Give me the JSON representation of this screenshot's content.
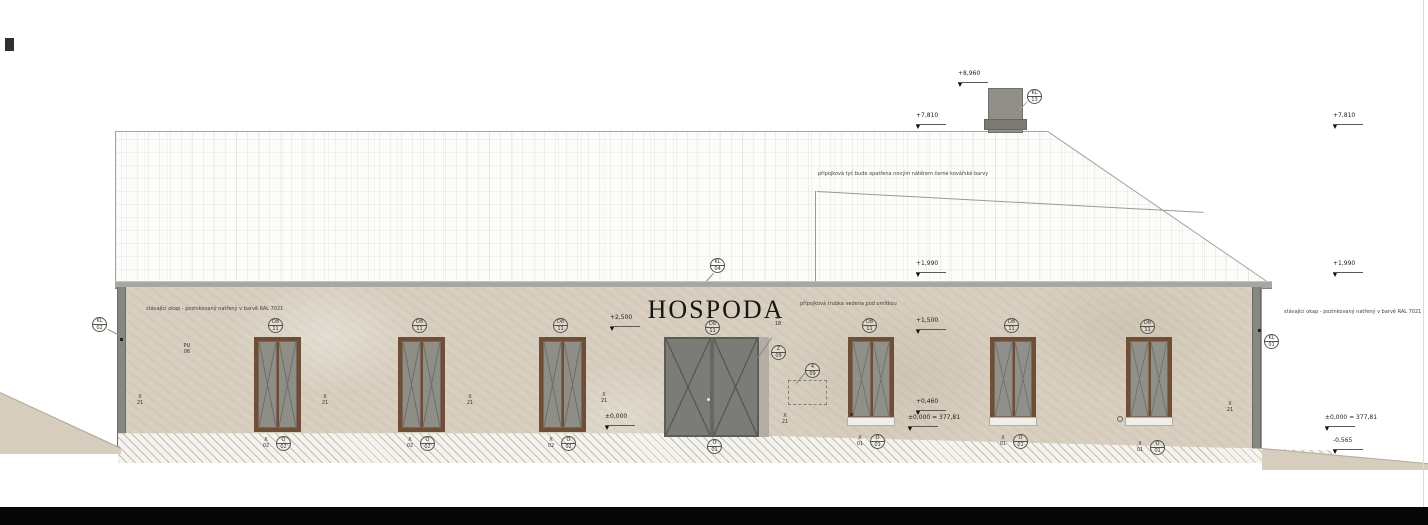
{
  "sign": {
    "text": "HOSPODA"
  },
  "colors": {
    "wall": "#d8cfc0",
    "roof": "#fcfcfb",
    "frame_brown": "#6e4e36",
    "door_gray": "#7b7b77",
    "gutter_gray": "#a7a7a1",
    "ground_black": "#070707"
  },
  "notes": [
    {
      "text": "stávající okap - pozinkovaný natřený v barvě RAL 7021",
      "x": 146,
      "y": 306
    },
    {
      "text": "stávající okap - pozinkovaný natřený v barvě RAL 7021",
      "x": 1284,
      "y": 309
    },
    {
      "text": "přípojková tyč bude opatřena novým nátěrem černé kovářské barvy",
      "x": 818,
      "y": 171
    },
    {
      "text": "přípojková trubka vedena pod omítkou",
      "x": 800,
      "y": 301
    }
  ],
  "circle_markers": [
    {
      "top": "KL",
      "bot": "02",
      "x": 92,
      "y": 317
    },
    {
      "top": "KL",
      "bot": "04",
      "x": 710,
      "y": 258
    },
    {
      "top": "KL",
      "bot": "13",
      "x": 1027,
      "y": 89
    },
    {
      "top": "KL",
      "bot": "01",
      "x": 1264,
      "y": 334
    },
    {
      "top": "D8",
      "bot": "11",
      "x": 268,
      "y": 318
    },
    {
      "top": "D8",
      "bot": "11",
      "x": 412,
      "y": 318
    },
    {
      "top": "D8",
      "bot": "11",
      "x": 553,
      "y": 318
    },
    {
      "top": "D8",
      "bot": "11",
      "x": 705,
      "y": 320
    },
    {
      "top": "D8",
      "bot": "11",
      "x": 862,
      "y": 318
    },
    {
      "top": "D8",
      "bot": "11",
      "x": 1004,
      "y": 318
    },
    {
      "top": "D8",
      "bot": "11",
      "x": 1140,
      "y": 319
    },
    {
      "top": "Z",
      "bot": "09",
      "x": 771,
      "y": 345
    },
    {
      "top": "4",
      "bot": "09",
      "x": 805,
      "y": 363
    },
    {
      "top": "O",
      "bot": "02",
      "x": 276,
      "y": 436
    },
    {
      "top": "O",
      "bot": "02",
      "x": 420,
      "y": 436
    },
    {
      "top": "O",
      "bot": "02",
      "x": 561,
      "y": 436
    },
    {
      "top": "O",
      "bot": "01",
      "x": 707,
      "y": 439
    },
    {
      "top": "O",
      "bot": "01",
      "x": 870,
      "y": 434
    },
    {
      "top": "O",
      "bot": "01",
      "x": 1013,
      "y": 434
    },
    {
      "top": "O",
      "bot": "01",
      "x": 1150,
      "y": 440
    }
  ],
  "text_markers": [
    {
      "top": "PU",
      "bot": "06",
      "x": 180,
      "y": 343
    },
    {
      "top": "X",
      "bot": "18",
      "x": 771,
      "y": 315
    },
    {
      "top": "X",
      "bot": "21",
      "x": 133,
      "y": 394
    },
    {
      "top": "X",
      "bot": "21",
      "x": 318,
      "y": 394
    },
    {
      "top": "X",
      "bot": "21",
      "x": 463,
      "y": 394
    },
    {
      "top": "X",
      "bot": "21",
      "x": 597,
      "y": 392
    },
    {
      "top": "X",
      "bot": "21",
      "x": 778,
      "y": 413
    },
    {
      "top": "X",
      "bot": "21",
      "x": 1223,
      "y": 401
    },
    {
      "top": "X",
      "bot": "02",
      "x": 259,
      "y": 437
    },
    {
      "top": "X",
      "bot": "02",
      "x": 403,
      "y": 437
    },
    {
      "top": "X",
      "bot": "02",
      "x": 544,
      "y": 437
    },
    {
      "top": "X",
      "bot": "01",
      "x": 853,
      "y": 435
    },
    {
      "top": "X",
      "bot": "01",
      "x": 996,
      "y": 435
    },
    {
      "top": "X",
      "bot": "01",
      "x": 1133,
      "y": 441
    }
  ],
  "elevation_flags": [
    {
      "val": "+8,960",
      "x": 958,
      "y": 70
    },
    {
      "val": "+7,810",
      "x": 916,
      "y": 112
    },
    {
      "val": "+7,810",
      "x": 1333,
      "y": 112
    },
    {
      "val": "+1,990",
      "x": 916,
      "y": 260
    },
    {
      "val": "+1,990",
      "x": 1333,
      "y": 260
    },
    {
      "val": "+2,500",
      "x": 610,
      "y": 314
    },
    {
      "val": "+1,500",
      "x": 916,
      "y": 317
    },
    {
      "val": "+0,460",
      "x": 916,
      "y": 398
    },
    {
      "val": "±0,000",
      "x": 605,
      "y": 413
    },
    {
      "val": "±0,000 = 377,81",
      "x": 908,
      "y": 414
    },
    {
      "val": "±0,000 = 377,81",
      "x": 1325,
      "y": 414
    },
    {
      "val": "-0,565",
      "x": 1333,
      "y": 437
    }
  ]
}
